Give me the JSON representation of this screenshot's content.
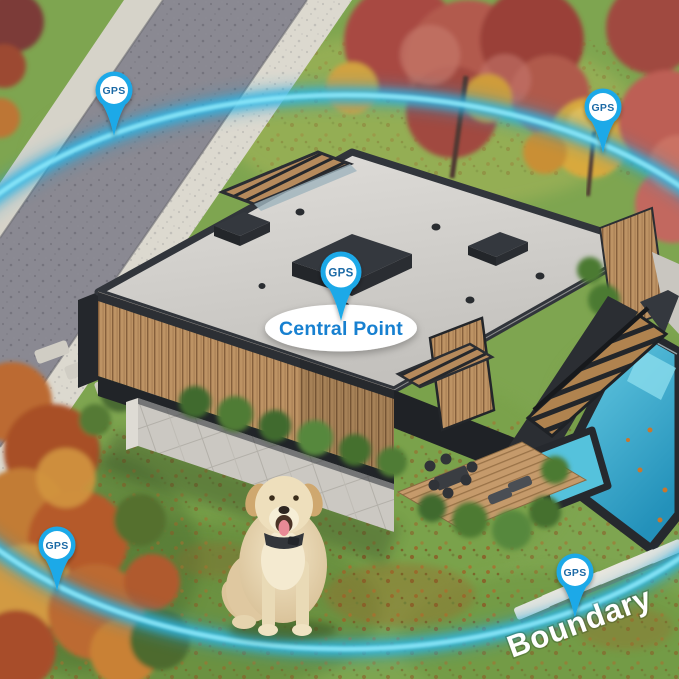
{
  "overlay": {
    "central_point_label": "Central Point",
    "boundary_label": "Boundary"
  },
  "pins": [
    {
      "position": "top-left",
      "label": "GPS"
    },
    {
      "position": "top-right",
      "label": "GPS"
    },
    {
      "position": "center",
      "label": "GPS"
    },
    {
      "position": "bottom-left",
      "label": "GPS"
    },
    {
      "position": "bottom-right",
      "label": "GPS"
    }
  ],
  "colors": {
    "pin_blue": "#1ea9e8",
    "pin_label_text": "#1d6ba6",
    "central_point_text": "#1780d0",
    "boundary_ring_glow": "#2fb7e6",
    "boundary_label_text": "#ffffff"
  }
}
